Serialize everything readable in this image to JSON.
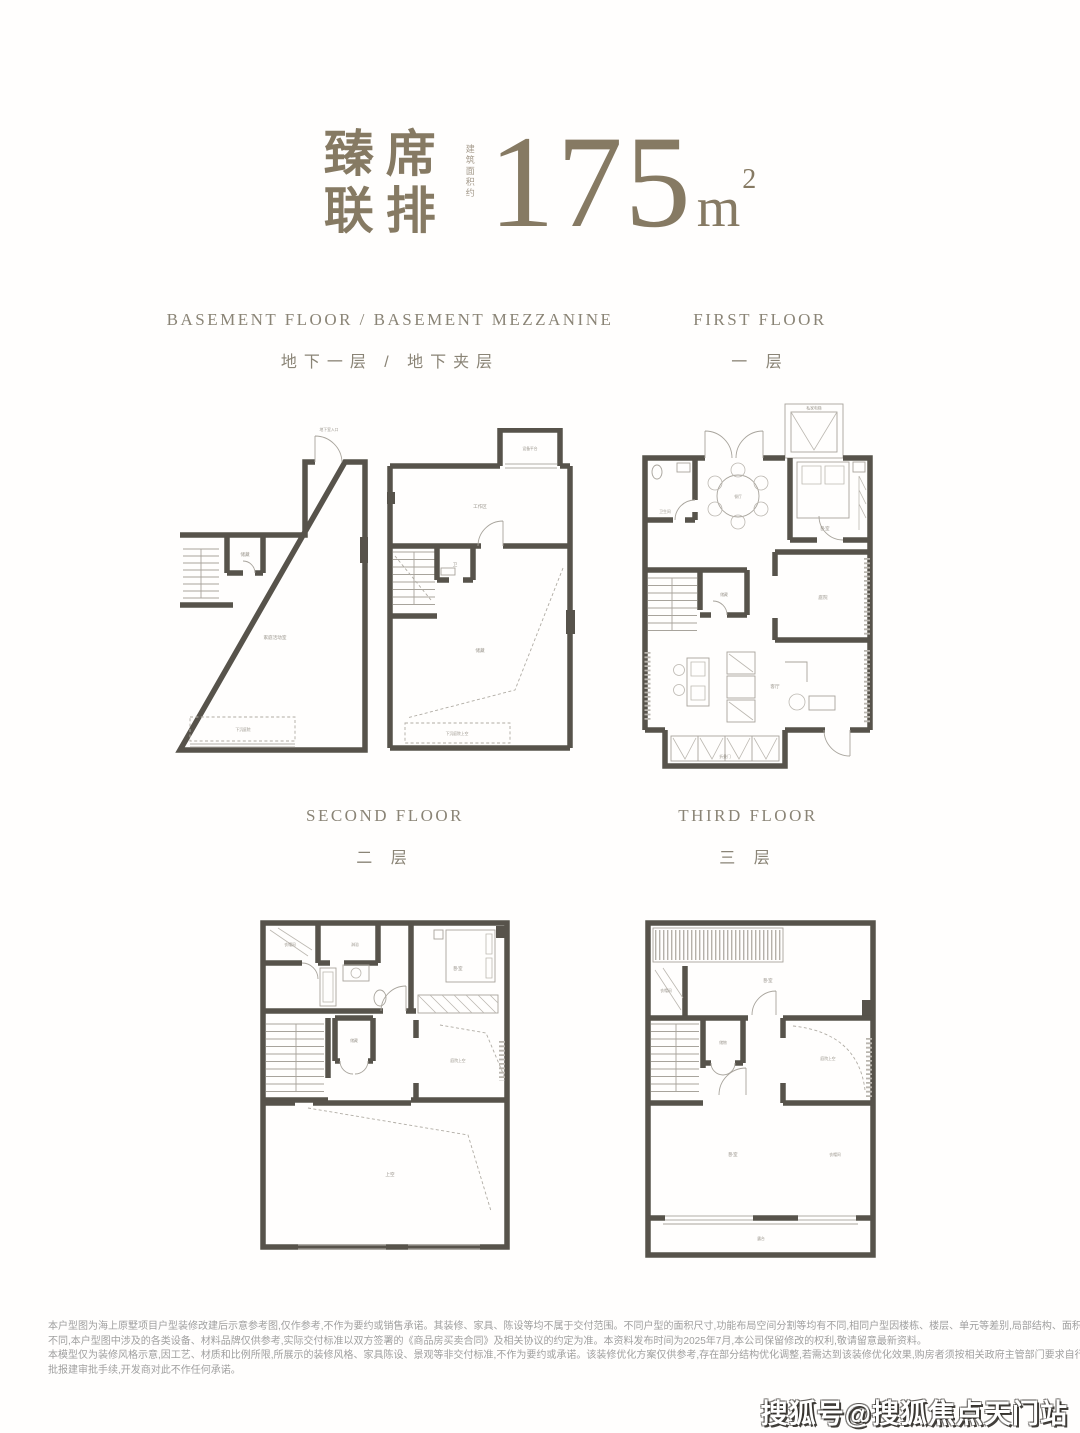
{
  "hero": {
    "title_line1": "臻席",
    "title_line2": "联排",
    "area_note": "建筑面积约",
    "area_value": "175",
    "area_unit": "m",
    "area_exp": "2"
  },
  "sections": {
    "basement": {
      "en": "BASEMENT FLOOR / BASEMENT MEZZANINE",
      "cn": "地下一层 / 地下夹层"
    },
    "first": {
      "en": "FIRST FLOOR",
      "cn": "一 层"
    },
    "second": {
      "en": "SECOND FLOOR",
      "cn": "二 层"
    },
    "third": {
      "en": "THIRD FLOOR",
      "cn": "三 层"
    }
  },
  "plans": {
    "basement_left": {
      "entry": "地下室入口",
      "storage": "储藏",
      "main": "家庭活动室",
      "sunken": "下沉庭院"
    },
    "basement_right": {
      "platform": "设备平台",
      "work": "工作区",
      "bath": "卫",
      "storage": "储藏",
      "sunken": "下沉庭院上空"
    },
    "first": {
      "elevator": "私家电梯",
      "bath": "卫生间",
      "dining": "餐厅",
      "bedroom": "卧室",
      "storage": "储藏",
      "courtyard": "庭院",
      "living": "客厅",
      "folding": "折叠门"
    },
    "second": {
      "cloak": "衣帽间",
      "shower": "淋浴",
      "bedroom": "卧室",
      "storage": "储藏",
      "void_right": "庭院上空",
      "void_main": "上空"
    },
    "third": {
      "cloak": "衣帽间",
      "bedroom_top": "卧室",
      "storage": "储物",
      "void_right": "庭院上空",
      "bedroom": "卧室",
      "closet": "衣帽间",
      "terrace": "露台"
    }
  },
  "disclaimer": {
    "line1": "本户型图为海上原墅项目户型装修改建后示意参考图,仅作参考,不作为要约或销售承诺。其装修、家具、陈设等均不属于交付范围。不同户型的面积尺寸,功能布局空间分割等均有不同,相同户型因楼栋、楼层、单元等差别,局部结构、面积等也可能",
    "line2": "不同,本户型图中涉及的各类设备、材料品牌仅供参考,实际交付标准以双方签署的《商品房买卖合同》及相关协议的约定为准。本资料发布时间为2025年7月,本公司保留修改的权利,敬请留意最新资料。",
    "line3": "本模型仅为装修风格示意,因工艺、材质和比例所限,所展示的装修风格、家具陈设、景观等非交付标准,不作为要约或承诺。该装修优化方案仅供参考,存在部分结构优化调整,若需达到该装修优化效果,购房者须按相关政府主管部门要求自行履行报",
    "line4": "批报建审批手续,开发商对此不作任何承诺。"
  },
  "watermark": "搜狐号@搜狐焦点天门站",
  "colors": {
    "accent": "#867a63",
    "wall": "#57534b",
    "section_label": "#8a8476",
    "disclaimer": "#9f9f9f"
  }
}
